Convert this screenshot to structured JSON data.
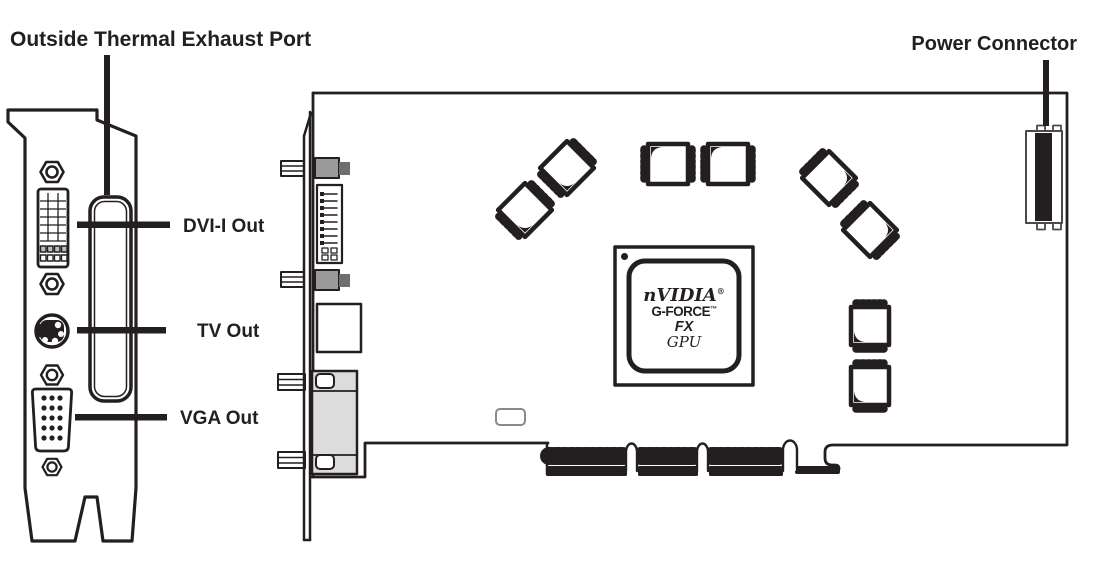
{
  "labels": {
    "thermal_exhaust": "Outside Thermal Exhaust Port",
    "dvi": "DVI-I Out",
    "tv": "TV Out",
    "vga": "VGA Out",
    "power": "Power Connector"
  },
  "gpu": {
    "brand": "nVIDIA",
    "brand_mark": "®",
    "model": "G-FORCE",
    "model_mark": "™",
    "series": "FX",
    "unit": "GPU"
  },
  "colors": {
    "ink": "#231f20",
    "gray_light": "#dcdcdc",
    "gray_mid": "#9a9a9a",
    "gray_dark": "#6e6e6e"
  }
}
